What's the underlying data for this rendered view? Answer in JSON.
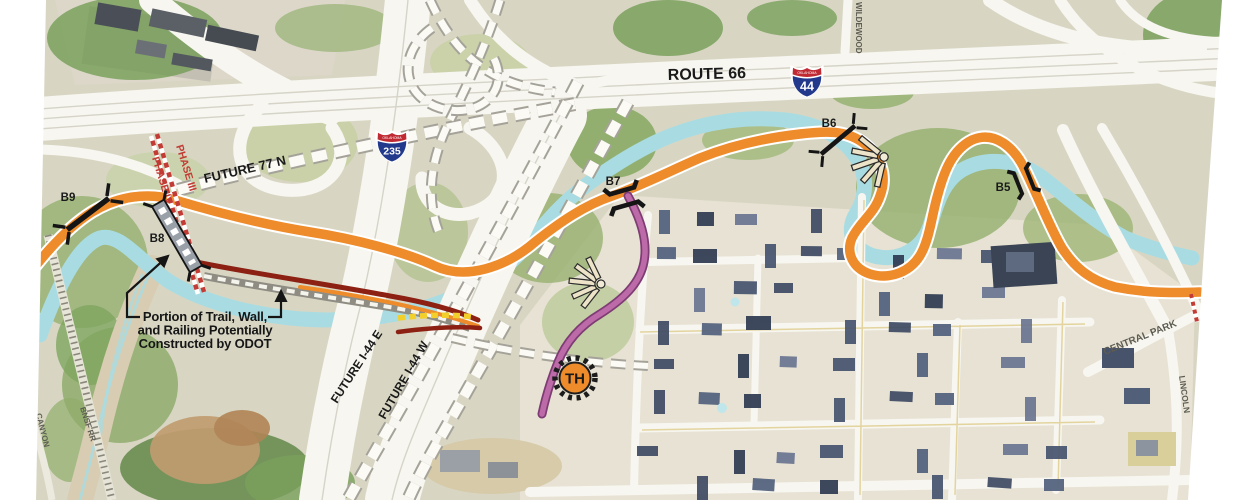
{
  "labels": {
    "route66": "ROUTE 66",
    "future77n": "FUTURE 77 N",
    "futureI44E": "FUTURE I-44 E",
    "futureI44W": "FUTURE I-44 W",
    "wildewood": "WILDEWOOD",
    "centralPark": "CENTRAL PARK",
    "lincoln": "LINCOLN",
    "bnsf": "BNSF RR",
    "canyon": "CANYON"
  },
  "shields": {
    "i44": {
      "number": "44",
      "state": "OKLAHOMA"
    },
    "i235": {
      "number": "235",
      "state": "OKLAHOMA"
    }
  },
  "phases": {
    "phase3": "PHASE III",
    "phase4": "PHASE IV"
  },
  "bridges": {
    "b5": "B5",
    "b6": "B6",
    "b7": "B7",
    "b8": "B8",
    "b9": "B9"
  },
  "trailhead": {
    "label": "TH"
  },
  "annotation": {
    "line1": "Portion of Trail, Wall,",
    "line2": "and Railing Potentially",
    "line3": "Constructed by ODOT"
  },
  "colors": {
    "trail-orange": "#EE8B2A",
    "trail-magenta": "#BD6BA8",
    "trail-magenta-dark": "#7E3C74",
    "odot-maroon": "#8C2012",
    "bridge-yellow": "#F2CF2B",
    "phase-red": "#C23B35",
    "creek-blue": "#A9DCE2",
    "shield-blue": "#23398C",
    "shield-red": "#BF2A33"
  }
}
